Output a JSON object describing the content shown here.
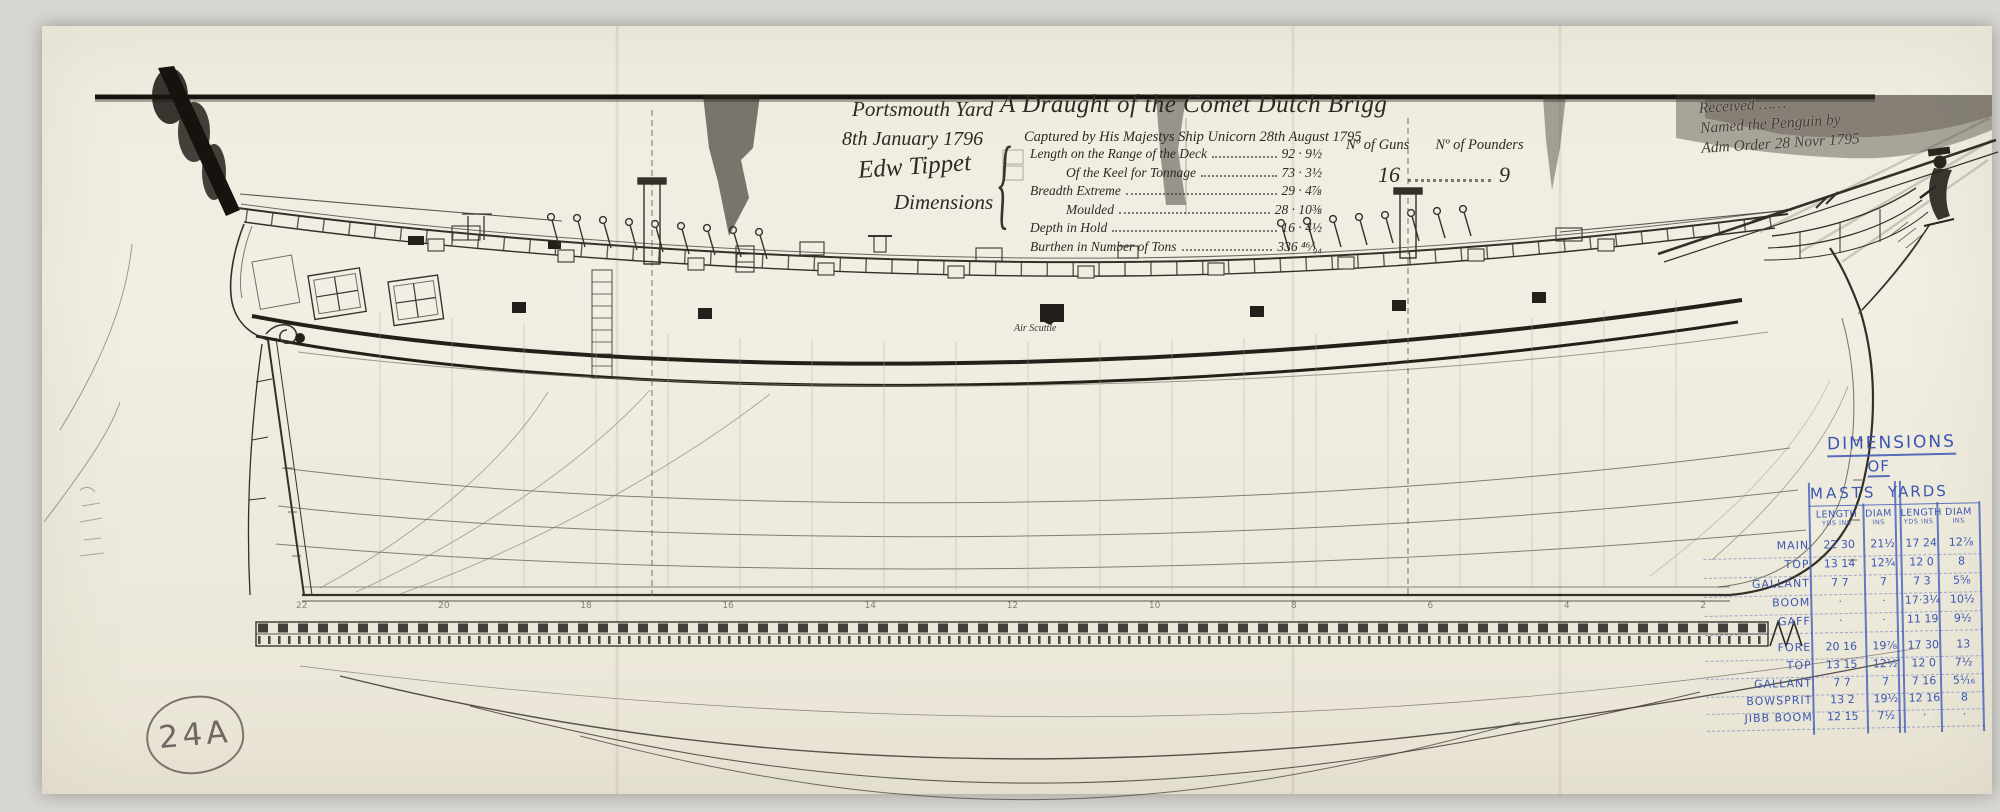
{
  "sheet": {
    "archive_mark": "24A",
    "stations": [
      "22",
      "20",
      "18",
      "16",
      "14",
      "12",
      "10",
      "8",
      "6",
      "4",
      "2"
    ]
  },
  "title_block": {
    "yard": "Portsmouth Yard",
    "date": "8th January 1796",
    "title": "A Draught of the Comet Dutch Brigg",
    "captured": "Captured by His Majestys Ship Unicorn 28th August 1795",
    "signature": "Edw Tippet",
    "dimensions_label": "Dimensions",
    "brace": "{",
    "rows": [
      {
        "label": "Length on the Range of the Deck",
        "value": "92 · 9½"
      },
      {
        "label": "Of the Keel for Tonnage",
        "value": "73 · 3½"
      },
      {
        "label": "Breadth Extreme",
        "value": "29 · 4⅞"
      },
      {
        "label": "Moulded",
        "value": "28 · 10⅜"
      },
      {
        "label": "Depth in Hold",
        "value": "16 · 4½"
      },
      {
        "label": "Burthen in Number of Tons",
        "value": "336 ⁴⁶⁄₉₄"
      }
    ],
    "guns_header": "Nº of Guns",
    "pounders_header": "Nº of Pounders",
    "guns_value": "16",
    "pounders_value": "9"
  },
  "received_note": {
    "line1": "Received ……",
    "line2": "Named the Penguin by",
    "line3": "Adm Order 28 Novr 1795"
  },
  "labels": {
    "air_scuttle": "Air Scuttle"
  },
  "mast_table": {
    "title_line1": "DIMENSIONS",
    "title_line2": "OF",
    "group_masts": "MASTS",
    "group_yards": "YARDS",
    "columns": [
      {
        "h": "LENGTH",
        "sub": "YDS INS"
      },
      {
        "h": "DIAM",
        "sub": "INS"
      },
      {
        "h": "LENGTH",
        "sub": "YDS INS"
      },
      {
        "h": "DIAM",
        "sub": "INS"
      }
    ],
    "rows": [
      {
        "name": "MAIN",
        "c0": "22 30",
        "c1": "21½",
        "c2": "17 24",
        "c3": "12⅞"
      },
      {
        "name": "TOP",
        "c0": "13 14",
        "c1": "12¾",
        "c2": "12 0",
        "c3": "8"
      },
      {
        "name": "GALLANT",
        "c0": "7 7",
        "c1": "7",
        "c2": "7 3",
        "c3": "5⅝"
      },
      {
        "name": "BOOM",
        "c0": "·",
        "c1": "·",
        "c2": "17·3¼",
        "c3": "10½"
      },
      {
        "name": "GAFF",
        "c0": "·",
        "c1": "·",
        "c2": "11 19",
        "c3": "9½"
      },
      {
        "name": "FORE",
        "c0": "20 16",
        "c1": "19⅞",
        "c2": "17 30",
        "c3": "13"
      },
      {
        "name": "TOP",
        "c0": "13 15",
        "c1": "12½",
        "c2": "12 0",
        "c3": "7½"
      },
      {
        "name": "GALLANT",
        "c0": "7 7",
        "c1": "7",
        "c2": "7 16",
        "c3": "5¹⁄₁₆"
      },
      {
        "name": "BOWSPRIT",
        "c0": "13 2",
        "c1": "19½",
        "c2": "12 16",
        "c3": "8"
      },
      {
        "name": "JIBB BOOM",
        "c0": "12 15",
        "c1": "7½",
        "c2": "·",
        "c3": "·"
      }
    ]
  }
}
